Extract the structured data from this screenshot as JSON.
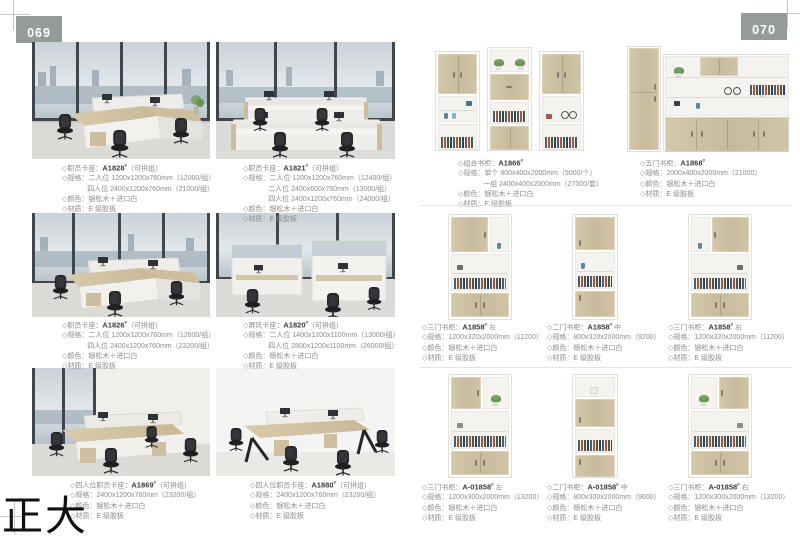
{
  "page": {
    "left_number": "069",
    "right_number": "070",
    "watermark": "正大"
  },
  "left_products": [
    {
      "title_prefix": "◇职员卡座：",
      "model": "A1828",
      "sup": "#",
      "title_suffix": "（可拼组）",
      "lines": [
        "◇规格：二人位 1200x1200x760mm（12000/组）",
        "四人位 2400x1200x760mm（21000/组）",
        "◇颜色：银松木＋进口白",
        "◇材质：E 级胶板"
      ]
    },
    {
      "title_prefix": "◇职员卡座：",
      "model": "A1821",
      "sup": "#",
      "title_suffix": "（可拼组）",
      "lines": [
        "◇规格：二人位 1200x1200x760mm（12400/组）",
        "二人位 2400x600x760mm（13000/组）",
        "四人位 2400x1200x760mm（24000/组）",
        "◇颜色：银松木＋进口白",
        "◇材质：E 级胶板"
      ]
    },
    {
      "title_prefix": "◇职员卡座：",
      "model": "A1826",
      "sup": "#",
      "title_suffix": "（可拼组）",
      "lines": [
        "◇规格：二人位 1200x1200x760mm（12600/组）",
        "四人位 2400x1200x760mm（23200/组）",
        "◇颜色：银松木＋进口白",
        "◇材质：E 级胶板"
      ]
    },
    {
      "title_prefix": "◇屏风卡座：",
      "model": "A1820",
      "sup": "#",
      "title_suffix": "（可拼组）",
      "lines": [
        "◇规格：二人位 1400x1200x1100mm（13000/组）",
        "四人位 2800x1200x1100mm（26000/组）",
        "◇颜色：银松木＋进口白",
        "◇材质：E 级胶板"
      ]
    },
    {
      "title_prefix": "◇四人位职员卡座：",
      "model": "A1869",
      "sup": "#",
      "title_suffix": "（可拼组）",
      "lines": [
        "◇规格：2400x1200x760mm（23200/组）",
        "◇颜色：银松木＋进口白",
        "◇材质：E 级胶板"
      ]
    },
    {
      "title_prefix": "◇四人位职员卡座：",
      "model": "A1880",
      "sup": "#",
      "title_suffix": "（可拼组）",
      "lines": [
        "◇规格：2400x1200x760mm（23200/组）",
        "◇颜色：银松木＋进口白",
        "◇材质：E 级胶板"
      ]
    }
  ],
  "right_top_products": [
    {
      "title_prefix": "◇组合书柜：",
      "model": "A1866",
      "sup": "#",
      "title_suffix": "",
      "lines": [
        "◇规格：单个 800x400x2000mm（9000/个）",
        "一组 2400x400x2000mm（27000/套）",
        "◇颜色：银松木＋进口白",
        "◇材质：E 级胶板"
      ]
    },
    {
      "title_prefix": "◇五门书柜：",
      "model": "A1868",
      "sup": "#",
      "title_suffix": "",
      "lines": [
        "◇规格：2000x400x2000mm（21000）",
        "◇颜色：银松木＋进口白",
        "◇材质：E 级胶板"
      ]
    }
  ],
  "right_mid_products": [
    {
      "title_prefix": "◇三门书柜：",
      "model": "A1858",
      "sup": "#",
      "title_suffix": " 左",
      "lines": [
        "◇规格：1200x320x2000mm（11200）",
        "◇颜色：银松木＋进口白",
        "◇材质：E 级胶板"
      ]
    },
    {
      "title_prefix": "◇二门书柜：",
      "model": "A1858",
      "sup": "#",
      "title_suffix": " 中",
      "lines": [
        "◇规格：800x320x2000mm（9200）",
        "◇颜色：银松木＋进口白",
        "◇材质：E 级胶板"
      ]
    },
    {
      "title_prefix": "◇三门书柜：",
      "model": "A1858",
      "sup": "#",
      "title_suffix": " 右",
      "lines": [
        "◇规格：1200x320x2000mm（11200）",
        "◇颜色：银松木＋进口白",
        "◇材质：E 级胶板"
      ]
    }
  ],
  "right_bottom_products": [
    {
      "title_prefix": "◇三门书柜：",
      "model": "A-01858",
      "sup": "#",
      "title_suffix": " 左",
      "lines": [
        "◇规格：1200x300x2000mm（13200）",
        "◇颜色：银松木＋进口白",
        "◇材质：E 级胶板"
      ]
    },
    {
      "title_prefix": "◇二门书柜：",
      "model": "A-01858",
      "sup": "#",
      "title_suffix": " 中",
      "lines": [
        "◇规格：800x300x2000mm（9600）",
        "◇颜色：银松木＋进口白",
        "◇材质：E 级胶板"
      ]
    },
    {
      "title_prefix": "◇三门书柜：",
      "model": "A-01858",
      "sup": "#",
      "title_suffix": " 右",
      "lines": [
        "◇规格：1200x300x2000mm（13200）",
        "◇颜色：银松木＋进口白",
        "◇材质：E 级胶板"
      ]
    }
  ],
  "colors": {
    "page_number_box": "#949b9a",
    "wood": "#cdbfa6",
    "caption_text": "#8c8c8c",
    "model_text": "#3b3b3b",
    "divider": "#e5e3df"
  }
}
